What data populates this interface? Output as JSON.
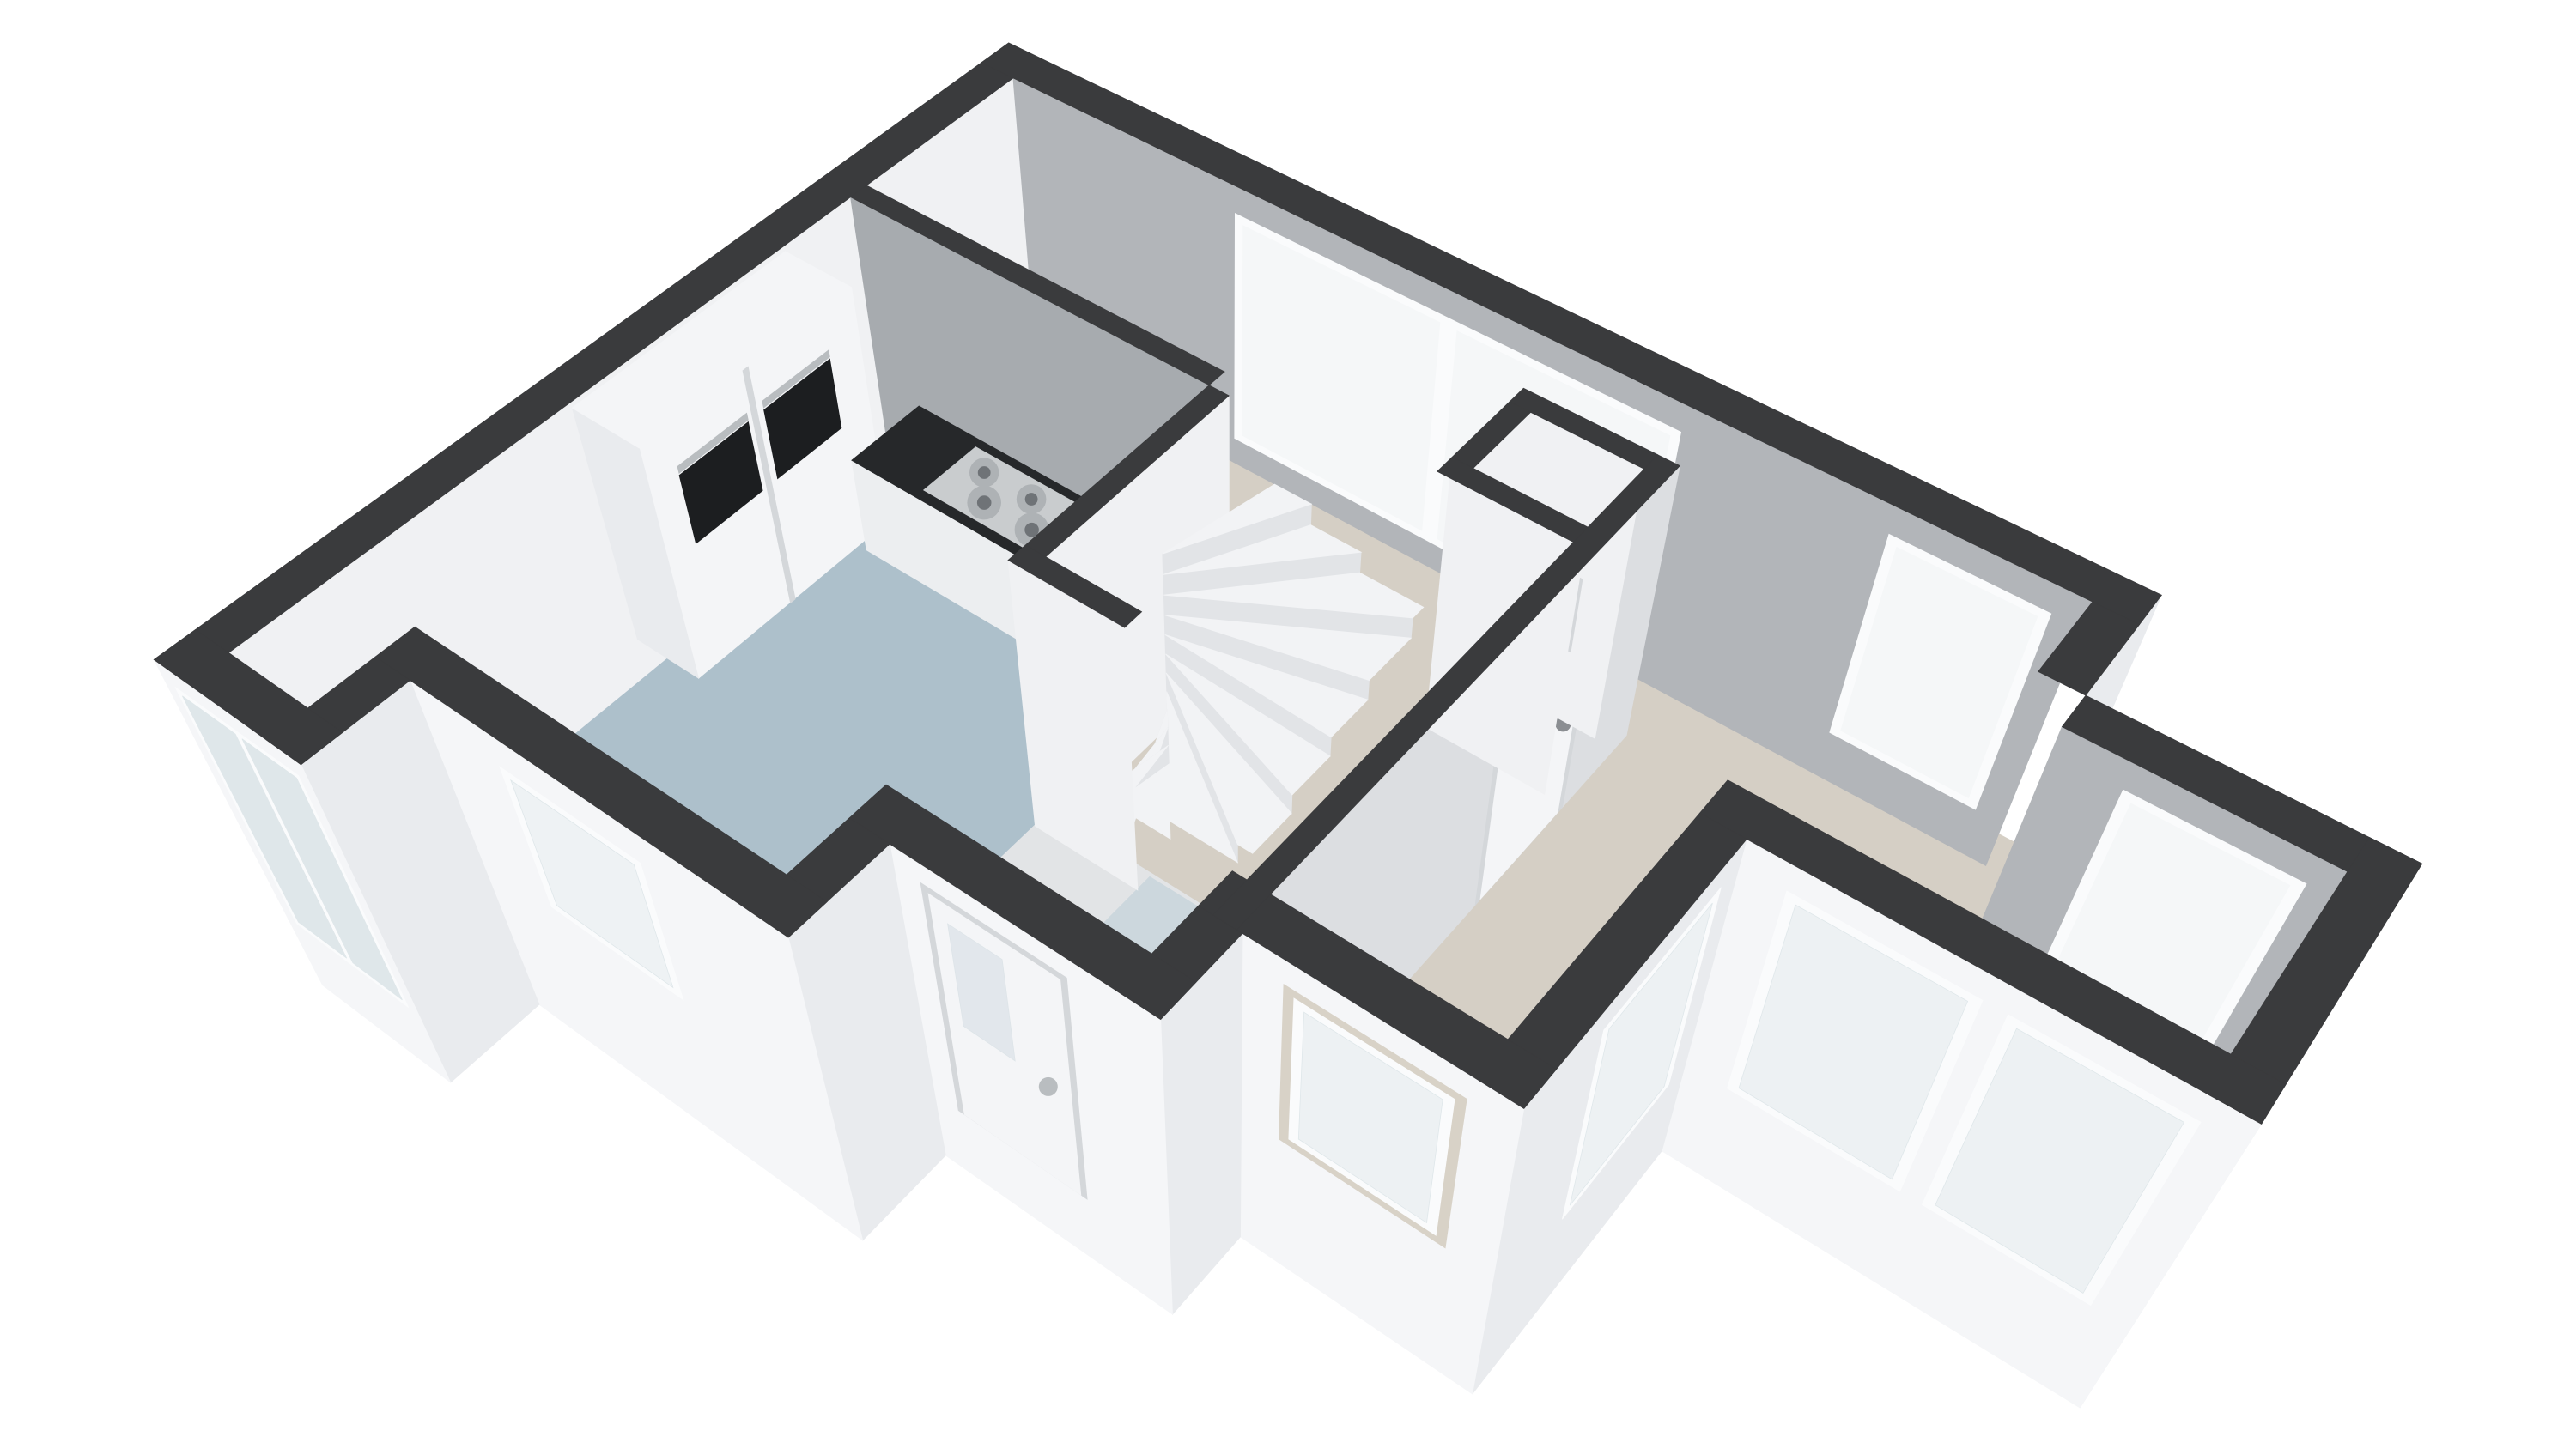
{
  "app": {
    "type": "3d-floorplan-render",
    "view": "perspective-top-down cutaway (dollhouse view)",
    "floor": "ground-floor",
    "background": "#ffffff"
  },
  "floorplan": {
    "rooms": [
      {
        "name": "living-dining-room",
        "floor_color_key": "floor_living",
        "shape": "L-around-core with window bay"
      },
      {
        "name": "kitchen",
        "floor_color_key": "floor_kitchen",
        "shape": "west strip with stepped south wall"
      },
      {
        "name": "hallway",
        "floor_color_key": "floor_hall",
        "shape": "between stair core and front door"
      },
      {
        "name": "stairwell",
        "floor_color_key": "floor_hall",
        "shape": "central core with winder stair"
      },
      {
        "name": "meter-closet",
        "floor_color_key": "floor_closet",
        "shape": "small cell north of hallway"
      }
    ],
    "features": [
      {
        "name": "winder-staircase",
        "treads": 11,
        "turn_degrees": 178
      },
      {
        "name": "kitchen-counter",
        "top": "dark",
        "base": "white"
      },
      {
        "name": "gas-cooktop",
        "burners": 6,
        "rows": 2
      },
      {
        "name": "tall-oven-cabinet",
        "ovens": 2
      },
      {
        "name": "kitchen-sink-faucet",
        "visible_through": "south kitchen window"
      },
      {
        "name": "wall-boiler-unit",
        "location": "kitchen south wall"
      },
      {
        "name": "meter-box",
        "accent": "red",
        "location": "meter closet"
      },
      {
        "name": "front-door",
        "glazing": "frosted pane",
        "handle": "steel"
      },
      {
        "name": "interior-living-door",
        "handle": "steel"
      },
      {
        "name": "ne-sliding-window",
        "panes": 2
      },
      {
        "name": "ne-small-window",
        "panes": 1
      },
      {
        "name": "bay-window-north",
        "panes": 1
      },
      {
        "name": "bay-window-east",
        "panes": 1
      },
      {
        "name": "bay-windows-south",
        "panes": 2
      },
      {
        "name": "east-tall-window",
        "panes": 1
      },
      {
        "name": "south-living-window",
        "panes": 1
      },
      {
        "name": "kitchen-sink-window",
        "panes": 1
      },
      {
        "name": "sliding-glass-door",
        "panes": 2
      }
    ]
  },
  "colors": {
    "background": "#ffffff",
    "wall_top": "#3a3b3d",
    "floor_living": "#d5cfc5",
    "floor_kitchen": "#adc0cb",
    "floor_hall": "#e2e4e6",
    "floor_closet": "#eceef0",
    "stair_mat": "#ccd7dd",
    "inner_white": "#f0f1f3",
    "inner_gray": "#b2b5b9",
    "inner_gray_mid": "#a7abaf",
    "hall_wall": "#dcdee1",
    "outer_white": "#f5f6f8",
    "outer_shade": "#e9ebee",
    "window_frame": "#fafbfc",
    "frame_shade": "#d4d7da",
    "reveal_beige": "#d8d2c7",
    "glass_far": "#f5f7f8",
    "glass_near": "#dfe7ea",
    "glass_door": "#dde4e8",
    "counter_top": "#26282a",
    "counter_base": "#eceef0",
    "cooktop_steel": "#c9ccce",
    "burner_ring": "#aeb2b5",
    "burner_dark": "#6f7377",
    "appliance_dark": "#1c1e20",
    "steel": "#b9bdc0",
    "accent_red": "#c0503c",
    "stair_tread": "#f2f3f5",
    "stair_riser": "#e2e4e7",
    "door_white": "#f4f5f7",
    "handle_dark": "#8b8e92"
  }
}
